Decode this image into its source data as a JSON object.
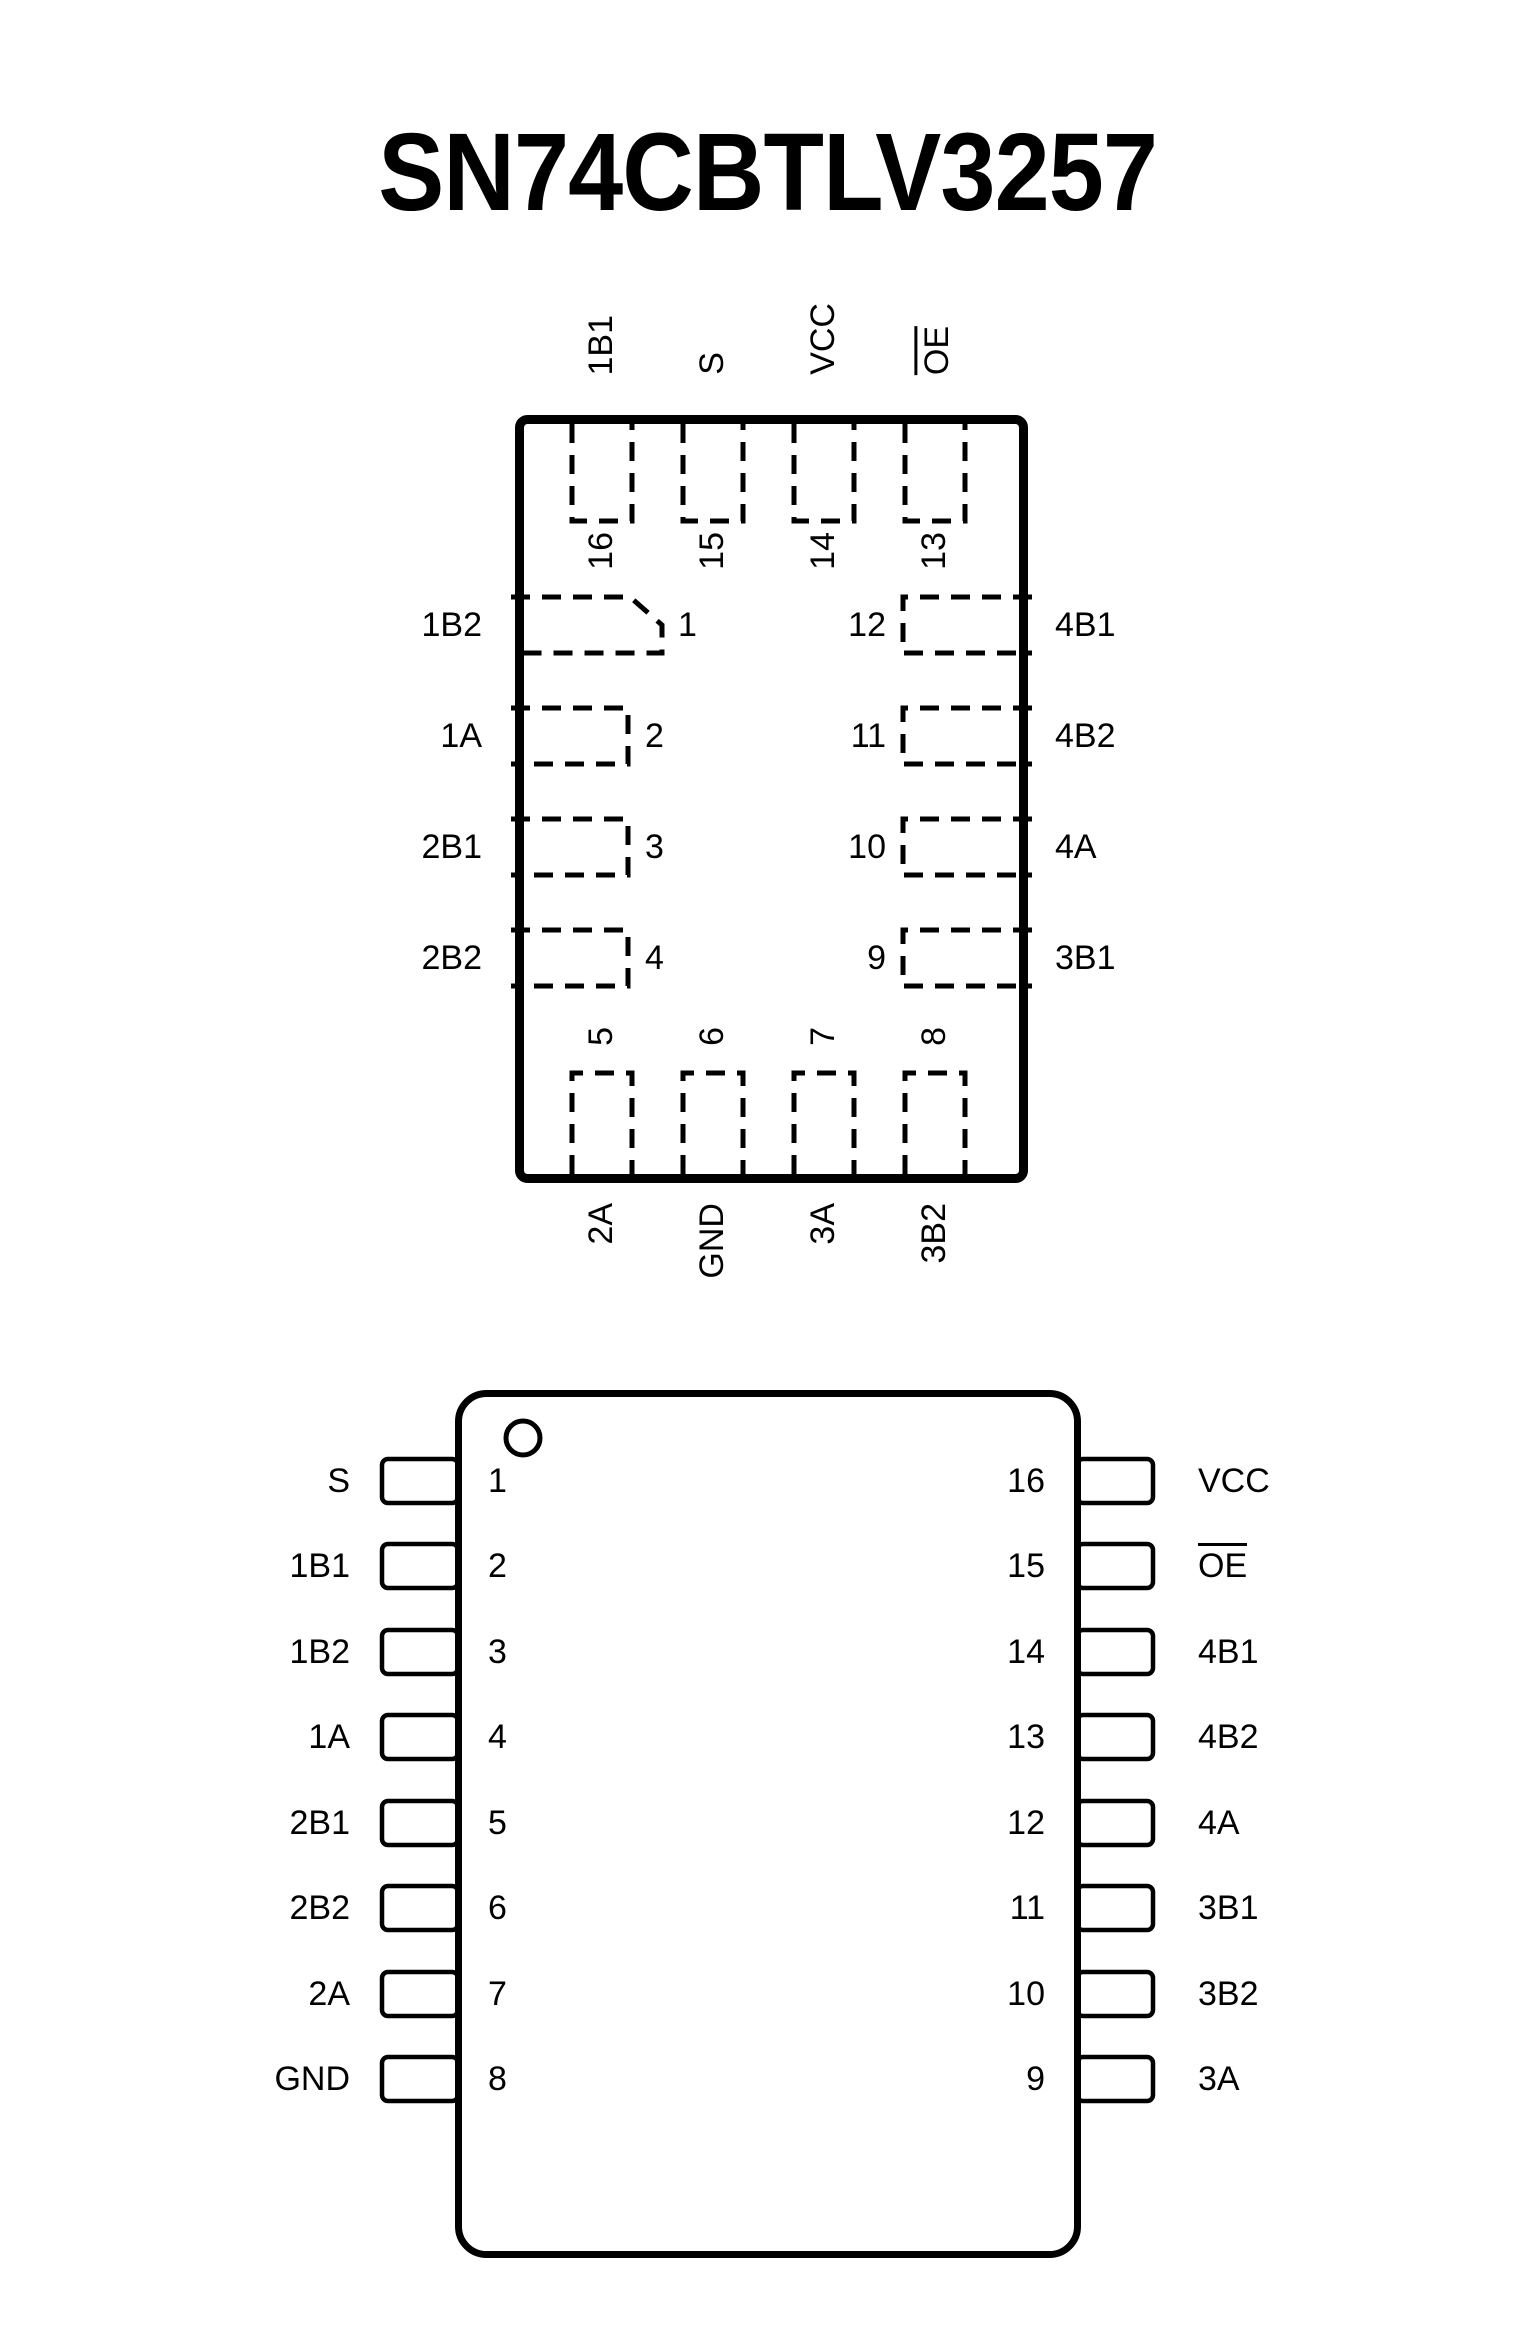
{
  "page": {
    "title": "SN74CBTLV3257",
    "background": "#ffffff",
    "line_color": "#000000"
  },
  "qfn_diagram": {
    "top_pins": [
      {
        "number": "16",
        "label": "1B1"
      },
      {
        "number": "15",
        "label": "S"
      },
      {
        "number": "14",
        "label": "VCC"
      },
      {
        "number": "13",
        "label": "OE",
        "overline": true
      }
    ],
    "left_pins": [
      {
        "number": "1",
        "label": "1B2"
      },
      {
        "number": "2",
        "label": "1A"
      },
      {
        "number": "3",
        "label": "2B1"
      },
      {
        "number": "4",
        "label": "2B2"
      }
    ],
    "right_pins": [
      {
        "number": "12",
        "label": "4B1"
      },
      {
        "number": "11",
        "label": "4B2"
      },
      {
        "number": "10",
        "label": "4A"
      },
      {
        "number": "9",
        "label": "3B1"
      }
    ],
    "bottom_pins": [
      {
        "number": "5",
        "label": "2A"
      },
      {
        "number": "6",
        "label": "GND"
      },
      {
        "number": "7",
        "label": "3A"
      },
      {
        "number": "8",
        "label": "3B2"
      }
    ]
  },
  "dip_diagram": {
    "left_pins": [
      {
        "number": "1",
        "label": "S"
      },
      {
        "number": "2",
        "label": "1B1"
      },
      {
        "number": "3",
        "label": "1B2"
      },
      {
        "number": "4",
        "label": "1A"
      },
      {
        "number": "5",
        "label": "2B1"
      },
      {
        "number": "6",
        "label": "2B2"
      },
      {
        "number": "7",
        "label": "2A"
      },
      {
        "number": "8",
        "label": "GND"
      }
    ],
    "right_pins": [
      {
        "number": "16",
        "label": "VCC"
      },
      {
        "number": "15",
        "label": "OE",
        "overline": true
      },
      {
        "number": "14",
        "label": "4B1"
      },
      {
        "number": "13",
        "label": "4B2"
      },
      {
        "number": "12",
        "label": "4A"
      },
      {
        "number": "11",
        "label": "3B1"
      },
      {
        "number": "10",
        "label": "3B2"
      },
      {
        "number": "9",
        "label": "3A"
      }
    ]
  }
}
